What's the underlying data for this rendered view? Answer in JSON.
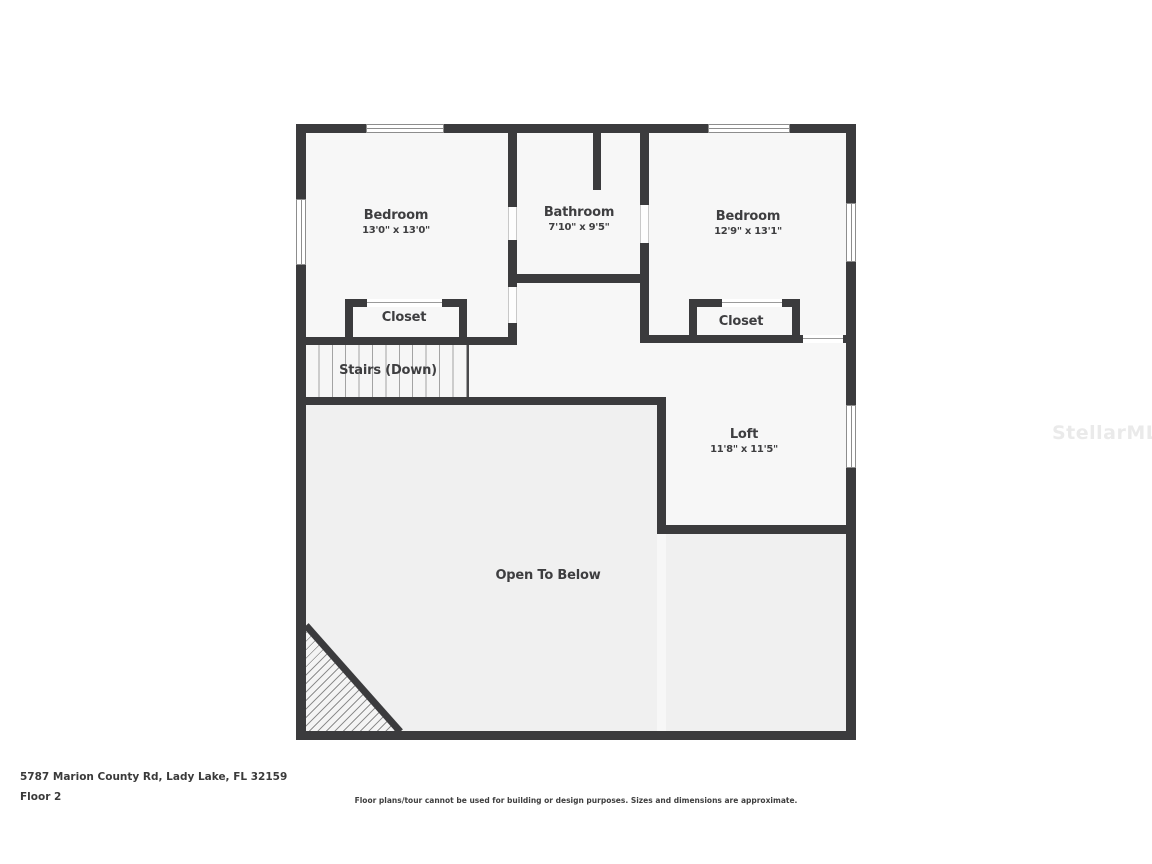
{
  "watermark": {
    "text": "StellarMLS"
  },
  "plan": {
    "rooms": {
      "bedroom_left": {
        "name": "Bedroom",
        "dims": "13'0\" x 13'0\""
      },
      "bathroom": {
        "name": "Bathroom",
        "dims": "7'10\" x 9'5\""
      },
      "bedroom_right": {
        "name": "Bedroom",
        "dims": "12'9\" x 13'1\""
      },
      "closet_left": {
        "name": "Closet"
      },
      "closet_right": {
        "name": "Closet"
      },
      "stairs": {
        "name": "Stairs (Down)"
      },
      "loft": {
        "name": "Loft",
        "dims": "11'8\" x 11'5\""
      },
      "open_to_below": {
        "name": "Open To Below"
      }
    }
  },
  "footer": {
    "address": "5787 Marion County Rd, Lady Lake, FL 32159",
    "floor_label": "Floor 2",
    "disclaimer": "Floor plans/tour cannot be used for building or design purposes. Sizes and dimensions are approximate."
  },
  "colors": {
    "wall": "#3b3b3d",
    "room_fill": "#f7f7f7",
    "open_area_fill": "#f0f0f0",
    "label_text": "#3e3e40",
    "watermark_text": "#eaeaea"
  }
}
